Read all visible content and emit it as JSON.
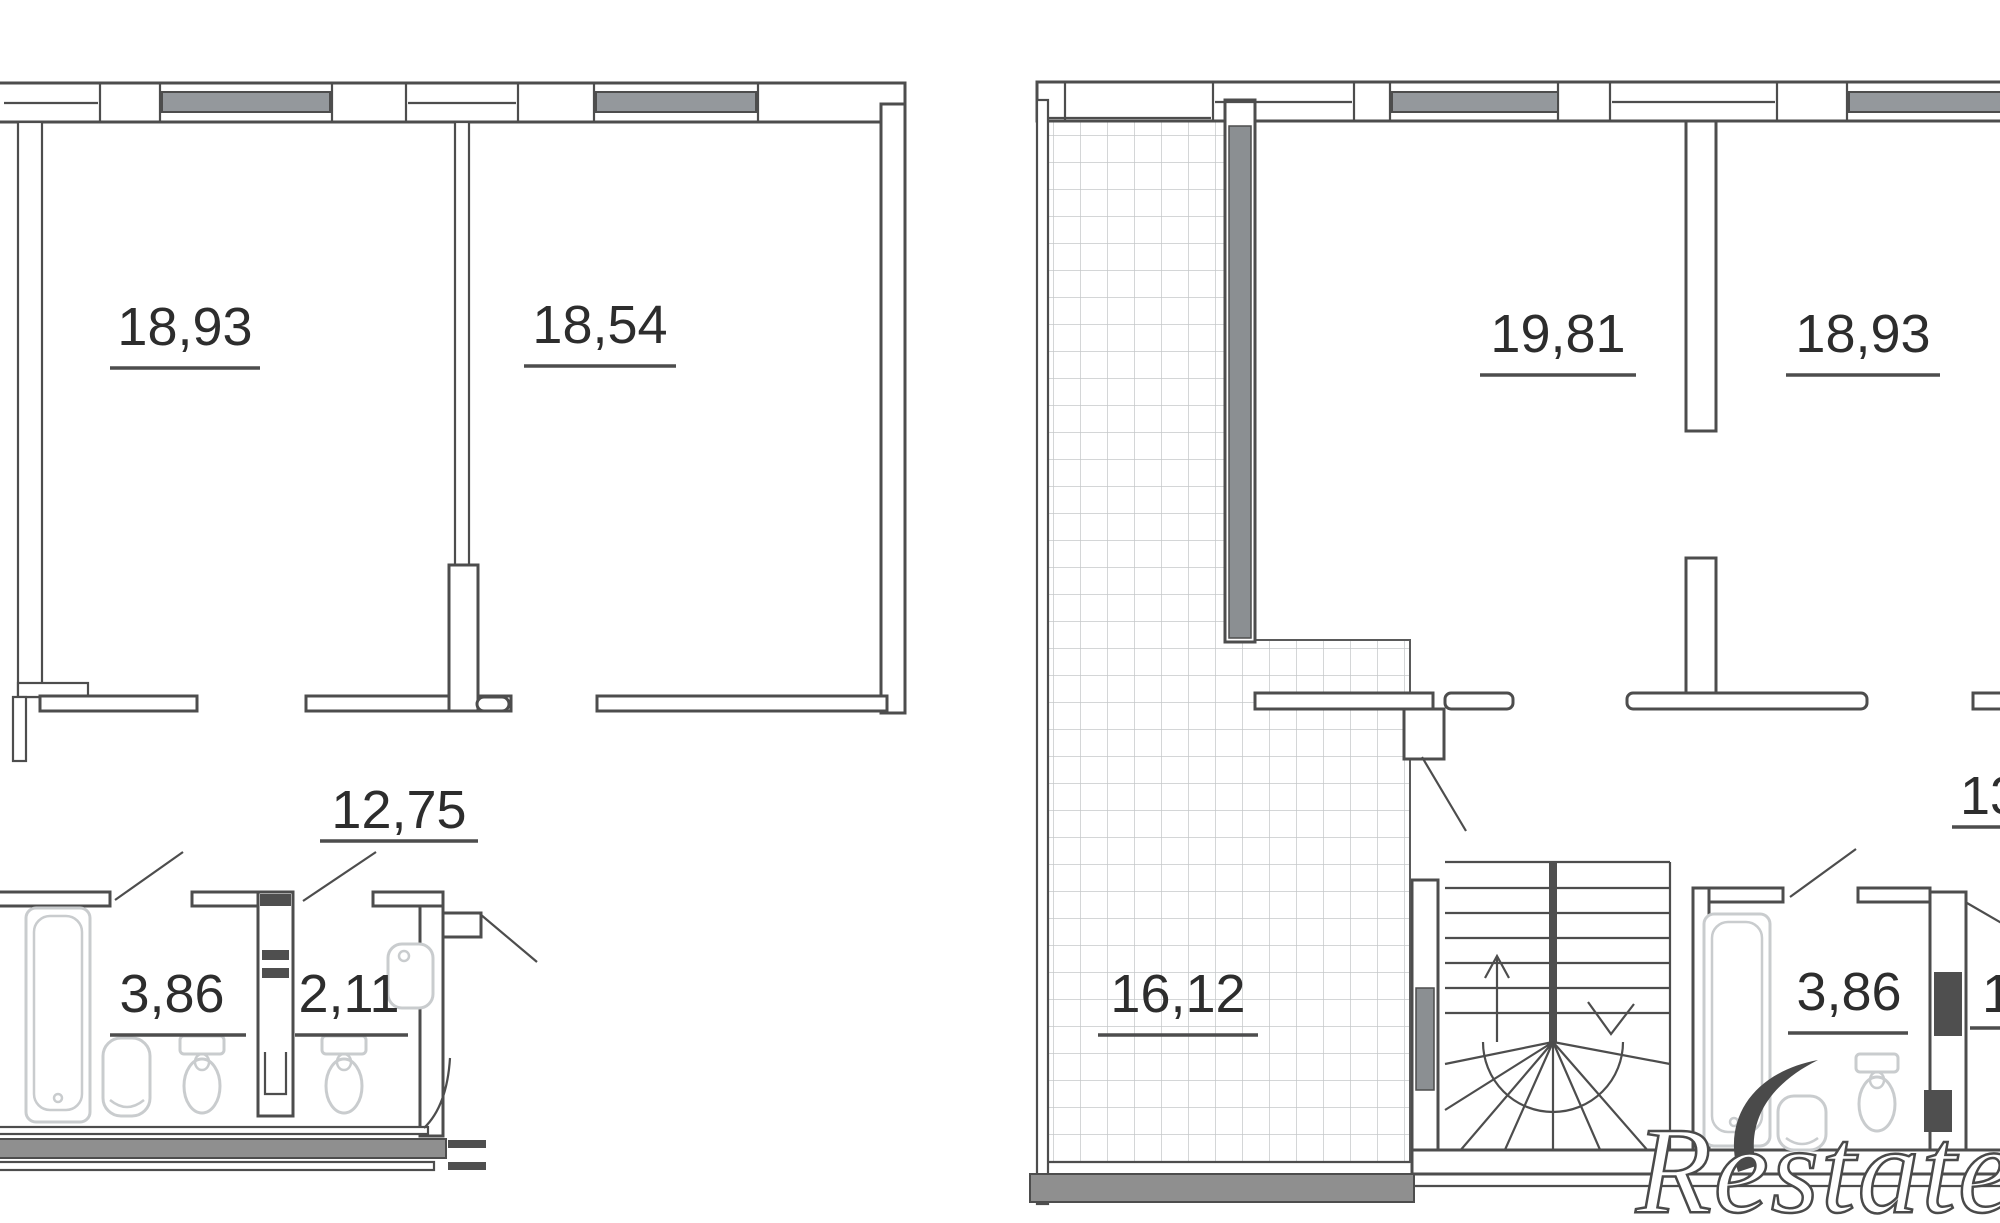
{
  "document": {
    "type": "apartment-floor-plan",
    "levels": 2
  },
  "left_plan": {
    "rooms": {
      "top_left": "18,93",
      "top_right": "18,54",
      "hall": "12,75",
      "bath": "3,86",
      "wc": "2,11"
    }
  },
  "right_plan": {
    "rooms": {
      "top_left": "19,81",
      "top_right": "18,93",
      "terrace": "16,12",
      "bath": "3,86",
      "right_clipped": "13",
      "right_lower_clipped": "1"
    }
  },
  "watermark": {
    "brand": "Restate"
  },
  "colors": {
    "wall_line": "#4d4d4d",
    "window_fill": "#94989c",
    "terrace_wall_fill": "#8b8f92",
    "heavy_wall_fill": "#8f8f8f",
    "fixture_line": "#c9ccce",
    "label_color": "#2d2d2d",
    "watermark_outline": "#4a4a4a"
  }
}
